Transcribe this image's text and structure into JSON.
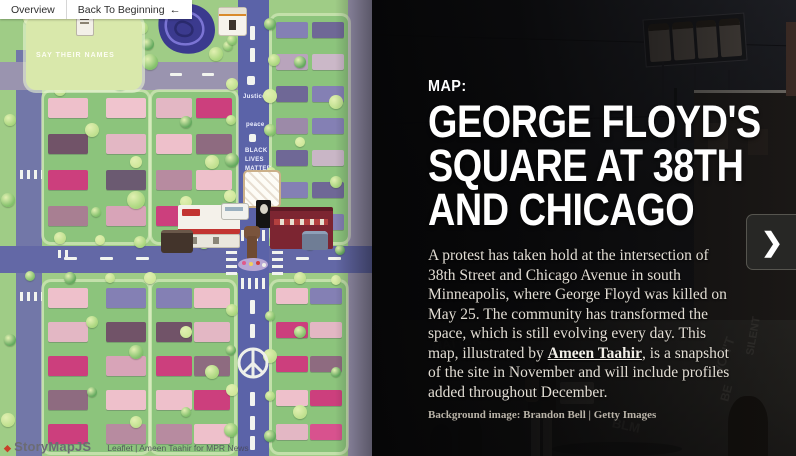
{
  "toolbar": {
    "overview_label": "Overview",
    "back_label": "Back To Beginning",
    "back_icon": "←"
  },
  "map": {
    "park_label": "SAY THEIR NAMES",
    "street_art": {
      "justice": "Justice",
      "peace": "peace",
      "blm": [
        "BLACK",
        "LIVES",
        "MATTER"
      ]
    },
    "colors": {
      "base_green": "#9fcc86",
      "block_green": "#8cc47c",
      "park_green": "#d9e8ab",
      "road_blue": "#5b63a8",
      "road_gray": "#9a94af",
      "pond_purple": "#3b3a8e"
    }
  },
  "panel": {
    "kicker": "MAP:",
    "title_lines": [
      "GEORGE FLOYD'S",
      "SQUARE AT 38TH",
      "AND CHICAGO"
    ],
    "body_1": "A protest has taken hold at the intersection of 38th Street and Chicago Avenue in south Minneapolis, where George Floyd was killed on May 25. The community has transformed the space, which is still evolving every day. This map, illustrated by ",
    "link_text": "Ameen Taahir",
    "body_2": ", is a snapshot of the site in November and will include profiles added throughout December.",
    "credit": "Background image: Brandon Bell | Getty Images",
    "next_icon": "❯",
    "photo_graffiti": [
      "WON'T",
      "BE",
      "SILENT",
      "MATTER",
      "BLM"
    ]
  },
  "attribution": {
    "storymap_label": "StoryMapJS",
    "storymap_icon": "◆",
    "leaflet_label": "Leaflet | Ameen Taahir for MPR News"
  }
}
